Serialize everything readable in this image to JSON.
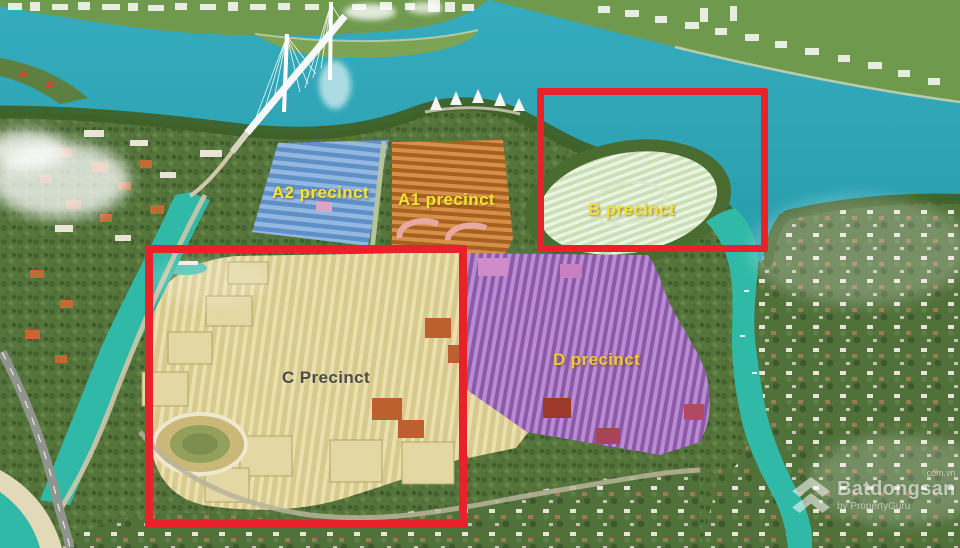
{
  "scene": {
    "type": "aerial-masterplan-render",
    "precincts": [
      {
        "id": "a2",
        "label": "A2 precinct",
        "highlighted": false
      },
      {
        "id": "a1",
        "label": "A1 precinct",
        "highlighted": false
      },
      {
        "id": "b",
        "label": "B precinct",
        "highlighted": true
      },
      {
        "id": "c",
        "label": "C Precinct",
        "highlighted": true
      },
      {
        "id": "d",
        "label": "D precinct",
        "highlighted": false
      }
    ],
    "colors": {
      "water": "#2ea8b6",
      "water_channel": "#2fb9a6",
      "land_green": "#55753c",
      "tree_dark": "#3f6128",
      "far_shore_green": "#6f9a4e",
      "city_white": "#f3f5ef",
      "beach": "#e6dfbe",
      "road": "#cfc7a8",
      "highway_gray": "#8f958c",
      "a2_base": "#93b7de",
      "a2_row": "#5e8fc6",
      "a1_base": "#a6601f",
      "a1_row": "#d69048",
      "b_base": "#cadfb6",
      "b_row": "#eef4e3",
      "c_base": "#d8c98c",
      "c_row": "#e9e0ae",
      "d_base": "#8e58a8",
      "d_row": "#b88cd2",
      "highlight_red": "#e8212b",
      "label_yellow": "#f2e530",
      "label_gold": "#eec643",
      "label_dark": "#4b4b44"
    }
  },
  "watermark": {
    "brand": "Batdongsan",
    "suffix": ".com.vn",
    "byline": "by PropertyGuru"
  }
}
